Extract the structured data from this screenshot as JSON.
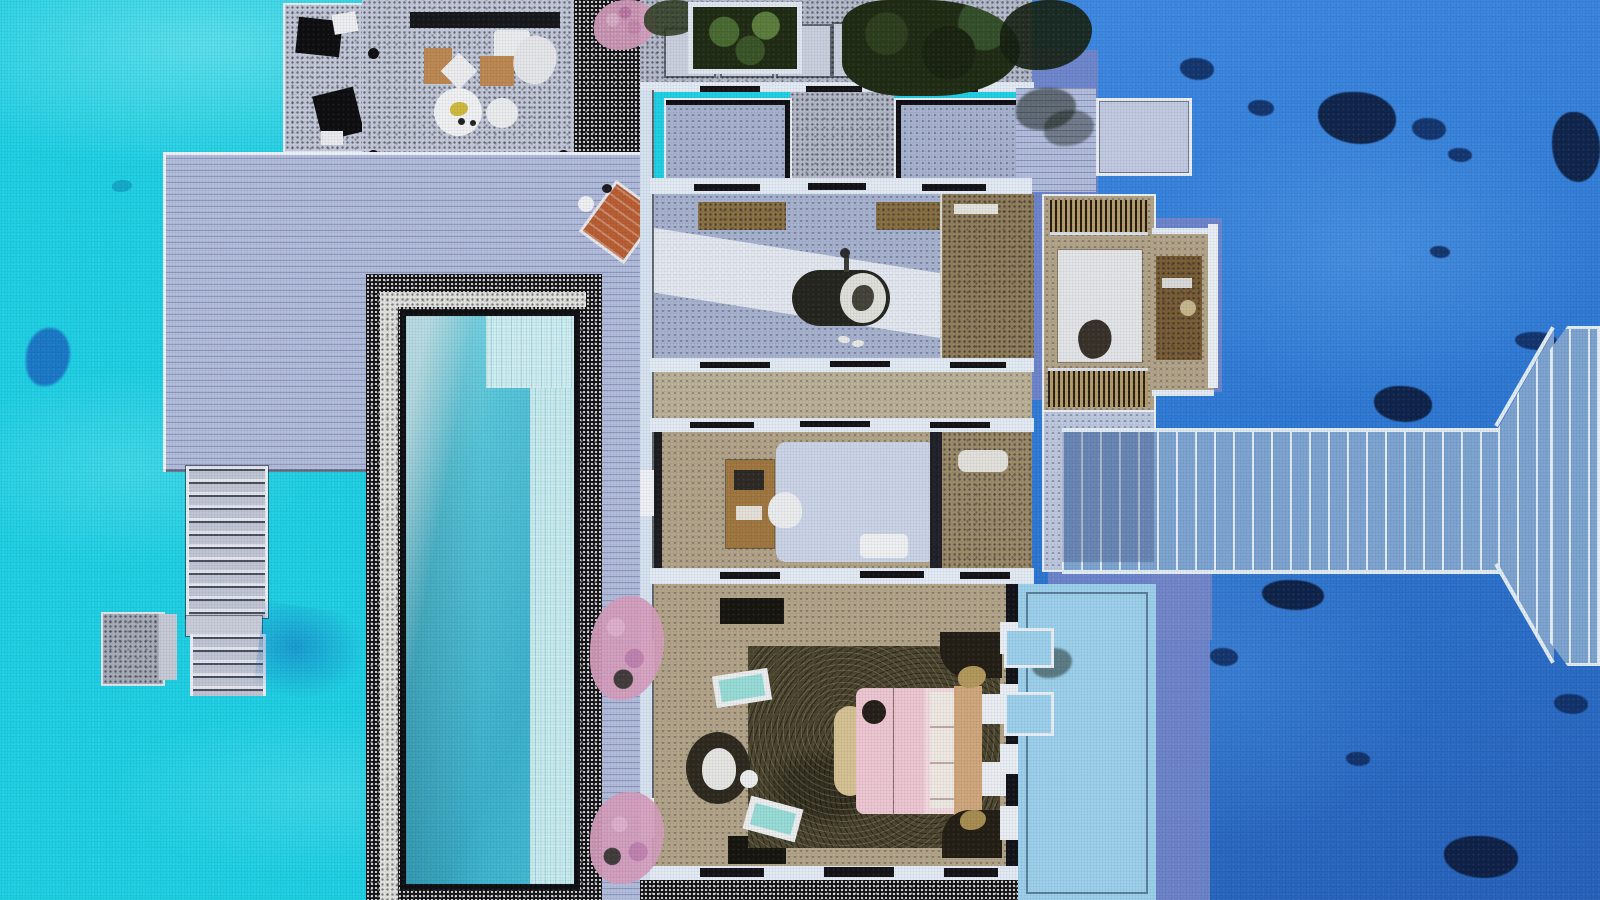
{
  "palette": {
    "lagoon": "#1fd3e7",
    "lagoon_light": "#8df0f7",
    "ocean": "#2f7cd8",
    "ocean_deep": "#2763bd",
    "coral": "#0e2a5e",
    "coral_dark": "#0a1634",
    "shadow": "#7488cd",
    "deck": "#b4bfe0",
    "deck_gray": "#c6ccdc",
    "dark": "#141417",
    "white": "#edf2f9",
    "wall": "#e6eef8",
    "floor_blue": "#a9b5d2",
    "floor_tan": "#b6a78b",
    "stone": "#93805c",
    "pool": "#46c0d6",
    "pool_light": "#9fe2ec",
    "pool_ledge": "#c7eff3",
    "wood": "#a27840",
    "wood_dark": "#6f5832",
    "bed_pink": "#f0c9d4",
    "headboard": "#d3a97e",
    "rug_dark": "#4c462f",
    "rug_white": "#e7e8eb",
    "aqua": "#9adfd9",
    "orange": "#bb5f33",
    "foliage": "#202c14",
    "flower": "#d9a0c0",
    "sundeck": "#9ed3ee",
    "jetty": "#7fa6d3",
    "plank": "#e6f0f8"
  },
  "regions": {
    "water": [
      "lagoon-shallow-west",
      "ocean-deep-east",
      "deck-shadow-on-water",
      "coral-patches",
      "stair-shadow"
    ],
    "decks": [
      "pergola-lounge-deck",
      "floating-sunbed-pad",
      "main-sun-deck",
      "pool-side-walkway",
      "entry-path",
      "stairs-to-water",
      "swim-platform",
      "sun-deck-southeast",
      "jetty-walkway",
      "arrival-platform-east"
    ],
    "pool": [
      "lap-pool",
      "tanning-ledge",
      "pool-surround-dark-stone",
      "pool-surround-white-band"
    ],
    "rooms": [
      "entry-vestibule-west",
      "entry-vestibule-east",
      "breezeway",
      "bathroom",
      "stone-shower",
      "dressing-room",
      "vanity-alcove",
      "study-lounge",
      "water-closet",
      "bedroom",
      "northeast-balcony"
    ],
    "furniture": [
      "outdoor-sofa-set",
      "round-dining-table",
      "dining-chair",
      "sun-lounger",
      "freestanding-bathtub",
      "double-vanity",
      "wardrobe",
      "white-rug",
      "ottoman-pouf",
      "writing-desk",
      "desk-chair",
      "daybed",
      "king-bed",
      "headboard",
      "pillows",
      "nightstand",
      "hanging-egg-chair",
      "aqua-stool",
      "bed-bench",
      "palm-leaf-rug",
      "sunbed-mat"
    ],
    "vegetation": [
      "bougainvillea-top",
      "green-planter",
      "tree-canopy",
      "poolside-bougainvillea-north",
      "poolside-bougainvillea-south"
    ]
  }
}
